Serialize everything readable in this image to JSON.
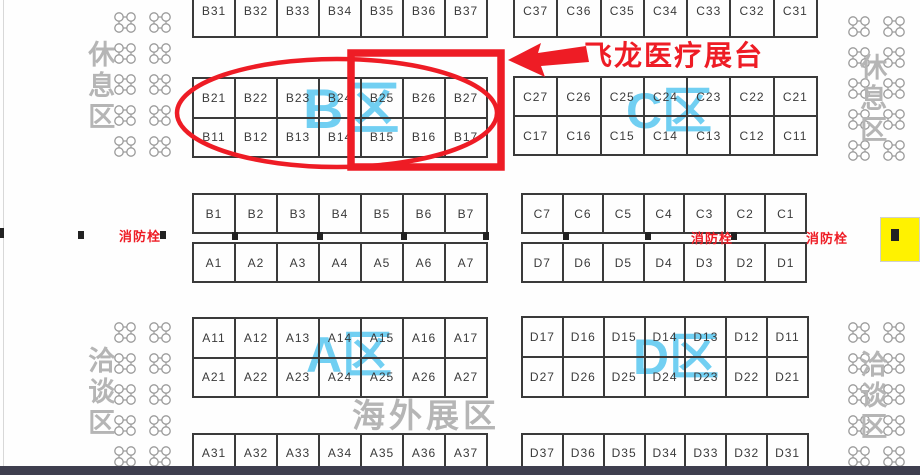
{
  "annotation": {
    "callout_label": "飞龙医疗展台",
    "fire_hydrant_label": "消防栓"
  },
  "area_labels": {
    "rest_area_top_left": "休息区",
    "rest_area_top_right": "休息区",
    "talk_area_bottom_left": "洽谈区",
    "talk_area_bottom_right": "洽谈区",
    "overseas_area": "海外展区"
  },
  "zone_labels": {
    "zone_a": "A区",
    "zone_b": "B区",
    "zone_c": "C区",
    "zone_d": "D区"
  },
  "blocks": {
    "b30s": [
      "B31",
      "B32",
      "B33",
      "B34",
      "B35",
      "B36",
      "B37"
    ],
    "c30s": [
      "C37",
      "C36",
      "C35",
      "C34",
      "C33",
      "C32",
      "C31"
    ],
    "b20s": [
      "B21",
      "B22",
      "B23",
      "B24",
      "B25",
      "B26",
      "B27"
    ],
    "b10s": [
      "B11",
      "B12",
      "B13",
      "B14",
      "B15",
      "B16",
      "B17"
    ],
    "c20s": [
      "C27",
      "C26",
      "C25",
      "C24",
      "C23",
      "C22",
      "C21"
    ],
    "c10s": [
      "C17",
      "C16",
      "C15",
      "C14",
      "C13",
      "C12",
      "C11"
    ],
    "b_front": [
      "B1",
      "B2",
      "B3",
      "B4",
      "B5",
      "B6",
      "B7"
    ],
    "a_front": [
      "A1",
      "A2",
      "A3",
      "A4",
      "A5",
      "A6",
      "A7"
    ],
    "c_front": [
      "C7",
      "C6",
      "C5",
      "C4",
      "C3",
      "C2",
      "C1"
    ],
    "d_front": [
      "D7",
      "D6",
      "D5",
      "D4",
      "D3",
      "D2",
      "D1"
    ],
    "a10s": [
      "A11",
      "A12",
      "A13",
      "A14",
      "A15",
      "A16",
      "A17"
    ],
    "a20s": [
      "A21",
      "A22",
      "A23",
      "A24",
      "A25",
      "A26",
      "A27"
    ],
    "d10s": [
      "D17",
      "D16",
      "D15",
      "D14",
      "D13",
      "D12",
      "D11"
    ],
    "d20s": [
      "D27",
      "D26",
      "D25",
      "D24",
      "D23",
      "D22",
      "D21"
    ],
    "a30s": [
      "A31",
      "A32",
      "A33",
      "A34",
      "A35",
      "A36",
      "A37"
    ],
    "d30s": [
      "D37",
      "D36",
      "D35",
      "D34",
      "D33",
      "D32",
      "D31"
    ]
  },
  "colors": {
    "highlight_red": "#ee1c25",
    "zone_blue": "#66ccf2",
    "area_gray": "#b5b5b5",
    "booth_border": "#3a3a3a",
    "exit_yellow": "#fff200",
    "bottom_bar": "#3e3e4e"
  }
}
